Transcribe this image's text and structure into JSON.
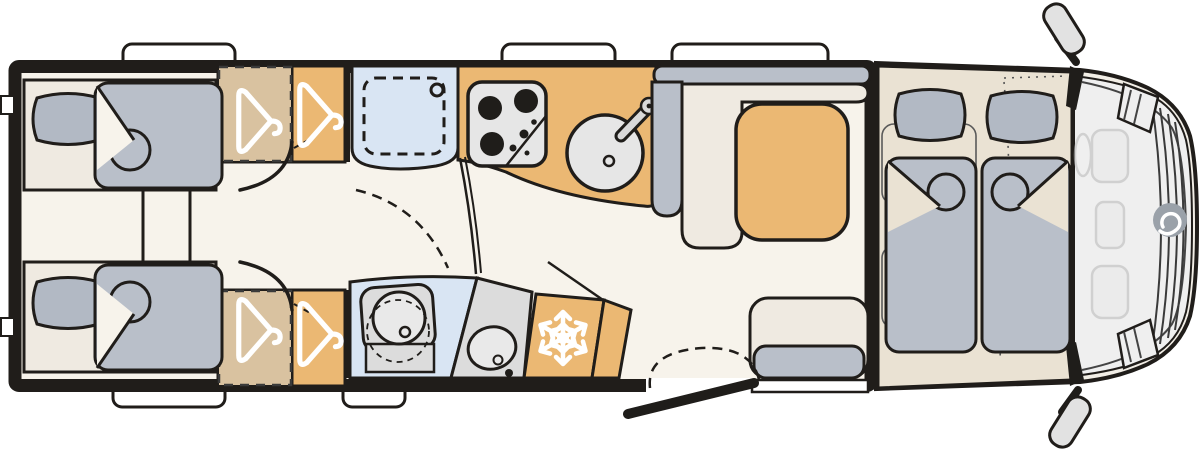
{
  "document": {
    "type": "motorhome-floor-plan",
    "view": "top-down layout, rear at left, driver cab at right",
    "visible_text": ""
  },
  "colors": {
    "page": "#ffffff",
    "wall": "#201d1a",
    "floor": "#f7f3eb",
    "furniture_cream": "#efeae1",
    "upholstery": "#b9bfc9",
    "pillow": "#b2b9c4",
    "tan": "#ebb873",
    "tan_muted": "#d9c2a0",
    "beige_bed_platform": "#eae2d3",
    "bath_blue": "#d9e5f3",
    "appliance_gray": "#e6e6e6",
    "appliance_mid": "#d9d9d9",
    "counter_gray": "#dcdcdc",
    "basin_gray": "#e9e9e9",
    "cab_body": "#f2eee6",
    "glass": "#efefef",
    "mirror_gray": "#e2e2e2",
    "faint_fill": "#e9e9e9",
    "logo_gray": "#9aa1a9",
    "white": "#ffffff",
    "black": "#1f1d1a"
  },
  "icons": {
    "wardrobe": "hanger-icon",
    "fridge": "snowflake-icon",
    "cooktop": "burner-icon",
    "sink": "faucet-icon",
    "shower": "drain-icon",
    "toilet": "toilet-icon",
    "front": "front-emblem-logo"
  },
  "areas": {
    "rear_bedroom": "twin-single-beds",
    "wardrobes": "two-hanger-closets-per-side",
    "bathroom_top": "shower-cubicle",
    "bathroom_bottom": "toilet-and-washbasin",
    "kitchen": "hob-and-round-sink",
    "fridge": "refrigerator",
    "dinette": "l-bench-with-table-and-side-bench",
    "entrance": "open-door-with-step",
    "front_bed": "drop-down-double-bed-over-cab",
    "cab": "driver-cab-with-two-seats"
  }
}
